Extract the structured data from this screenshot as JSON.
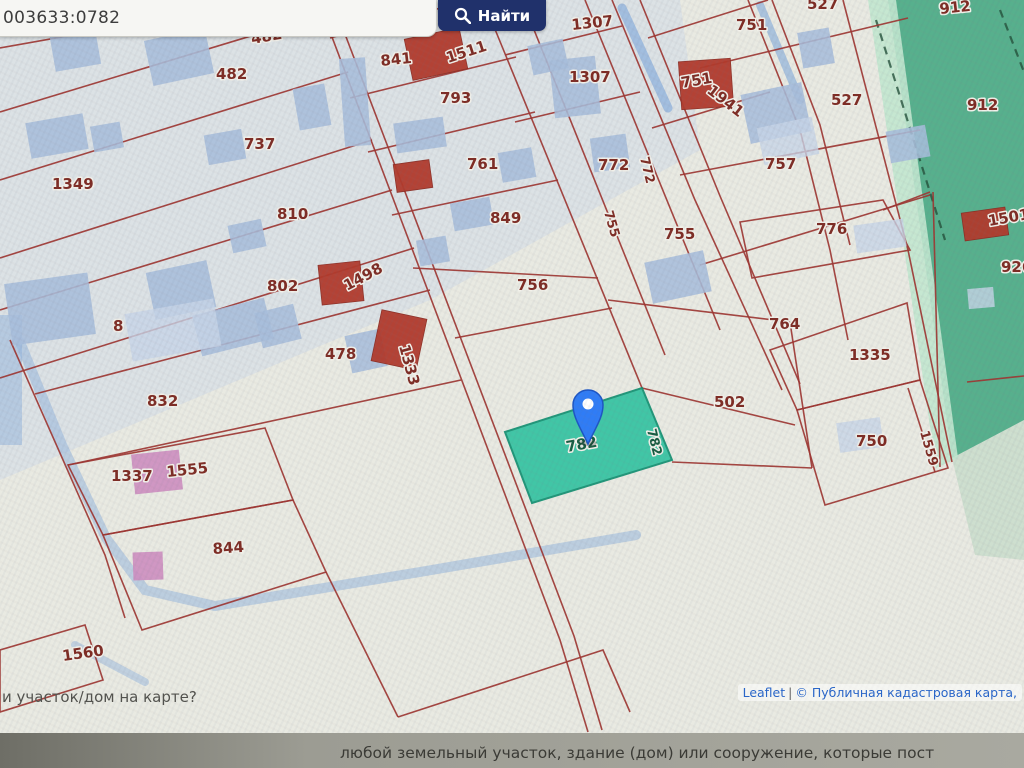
{
  "search": {
    "value": "003633:0782",
    "button_label": "Найти"
  },
  "attribution": {
    "leaflet": "Leaflet",
    "separator": "|",
    "source": "© Публичная кадастровая карта,"
  },
  "page": {
    "question": "и участок/дом на карте?",
    "banner_text": "любой земельный участок, здание (дом) или сооружение, которые пост"
  },
  "map": {
    "selected_parcel": "782",
    "marker": "map-pin",
    "labels": [
      {
        "t": "482",
        "x": 252,
        "y": 44,
        "r": -10
      },
      {
        "t": "482",
        "x": 216,
        "y": 79,
        "r": 0
      },
      {
        "t": "737",
        "x": 244,
        "y": 149,
        "r": 0
      },
      {
        "t": "1349",
        "x": 52,
        "y": 189,
        "r": 0
      },
      {
        "t": "810",
        "x": 277,
        "y": 219,
        "r": 0
      },
      {
        "t": "802",
        "x": 267,
        "y": 291,
        "r": 0
      },
      {
        "t": "1498",
        "x": 347,
        "y": 291,
        "r": -28
      },
      {
        "t": "8",
        "x": 113,
        "y": 331,
        "r": 0
      },
      {
        "t": "478",
        "x": 325,
        "y": 359,
        "r": 0
      },
      {
        "t": "1333",
        "x": 399,
        "y": 346,
        "r": 75
      },
      {
        "t": "832",
        "x": 147,
        "y": 406,
        "r": 0
      },
      {
        "t": "1337",
        "x": 111,
        "y": 481,
        "r": 0
      },
      {
        "t": "1555",
        "x": 167,
        "y": 477,
        "r": -6
      },
      {
        "t": "844",
        "x": 213,
        "y": 554,
        "r": -4
      },
      {
        "t": "1560",
        "x": 63,
        "y": 661,
        "r": -8
      },
      {
        "t": "841",
        "x": 438,
        "y": 26,
        "r": 0
      },
      {
        "t": "841",
        "x": 381,
        "y": 66,
        "r": -6
      },
      {
        "t": "1511",
        "x": 448,
        "y": 63,
        "r": -18
      },
      {
        "t": "793",
        "x": 440,
        "y": 103,
        "r": 0
      },
      {
        "t": "1307",
        "x": 572,
        "y": 30,
        "r": -6
      },
      {
        "t": "1307",
        "x": 569,
        "y": 82,
        "r": 0
      },
      {
        "t": "761",
        "x": 467,
        "y": 169,
        "r": 0
      },
      {
        "t": "772",
        "x": 598,
        "y": 170,
        "r": 0
      },
      {
        "t": "772",
        "x": 640,
        "y": 158,
        "r": 76,
        "cls": "sm"
      },
      {
        "t": "849",
        "x": 490,
        "y": 223,
        "r": 0
      },
      {
        "t": "755",
        "x": 604,
        "y": 212,
        "r": 74,
        "cls": "sm"
      },
      {
        "t": "755",
        "x": 664,
        "y": 239,
        "r": 0
      },
      {
        "t": "756",
        "x": 517,
        "y": 290,
        "r": 0
      },
      {
        "t": "764",
        "x": 769,
        "y": 329,
        "r": 0
      },
      {
        "t": "502",
        "x": 714,
        "y": 407,
        "r": 0
      },
      {
        "t": "782",
        "x": 567,
        "y": 452,
        "r": -10,
        "cls": "green"
      },
      {
        "t": "782",
        "x": 647,
        "y": 430,
        "r": 76,
        "cls": "green sm"
      },
      {
        "t": "751",
        "x": 736,
        "y": 30,
        "r": 0
      },
      {
        "t": "751",
        "x": 682,
        "y": 88,
        "r": -10
      },
      {
        "t": "1941",
        "x": 706,
        "y": 92,
        "r": 38
      },
      {
        "t": "527",
        "x": 807,
        "y": 9,
        "r": 0
      },
      {
        "t": "527",
        "x": 831,
        "y": 105,
        "r": 0
      },
      {
        "t": "757",
        "x": 765,
        "y": 169,
        "r": 0
      },
      {
        "t": "776",
        "x": 816,
        "y": 234,
        "r": 0
      },
      {
        "t": "1335",
        "x": 849,
        "y": 360,
        "r": 0
      },
      {
        "t": "750",
        "x": 856,
        "y": 446,
        "r": 0
      },
      {
        "t": "1559",
        "x": 920,
        "y": 432,
        "r": 74,
        "cls": "sm"
      },
      {
        "t": "912",
        "x": 940,
        "y": 14,
        "r": -6
      },
      {
        "t": "912",
        "x": 967,
        "y": 110,
        "r": 0
      },
      {
        "t": "1501",
        "x": 989,
        "y": 226,
        "r": -10
      },
      {
        "t": "926",
        "x": 1001,
        "y": 272,
        "r": 0
      }
    ]
  },
  "colors": {
    "button_bg": "#20316b",
    "parcel_line": "#9d3531",
    "selected_fill": "#2fc3a0",
    "selected_stroke": "#0c8e6e",
    "marker": "#2f7cf6",
    "green_zone": "#57b08d",
    "label": "#7e2b23",
    "label_green": "#175c41",
    "link": "#2a66c8"
  }
}
